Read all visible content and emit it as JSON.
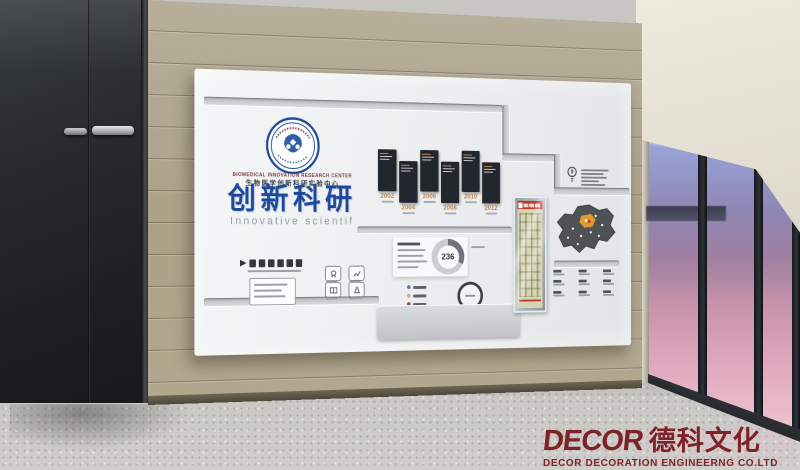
{
  "wall": {
    "org_en": "BIOMEDICAL INNOVATION RESEARCH CENTER",
    "org_zh": "生物医学创新科研实验中心",
    "title_zh": "创新科研",
    "title_en": "Innovative scientif",
    "slogan_marker": "▶",
    "timeline_years": [
      "2002",
      "2004",
      "2006",
      "2008",
      "2010",
      "2012"
    ],
    "donut_value": "236"
  },
  "watermark": {
    "brand_en": "DECOR",
    "brand_zh": "德科文化",
    "subtitle": "DECOR DECORATION ENGINEERNG CO.LTD"
  },
  "colors": {
    "title_blue": "#1b4a9b",
    "timeline_tan": "#c08a4f",
    "watermark_red": "#7d2227",
    "wood": "#b0a58f",
    "sky_top": "#5f74bd",
    "sky_pink": "#eec4cf"
  }
}
